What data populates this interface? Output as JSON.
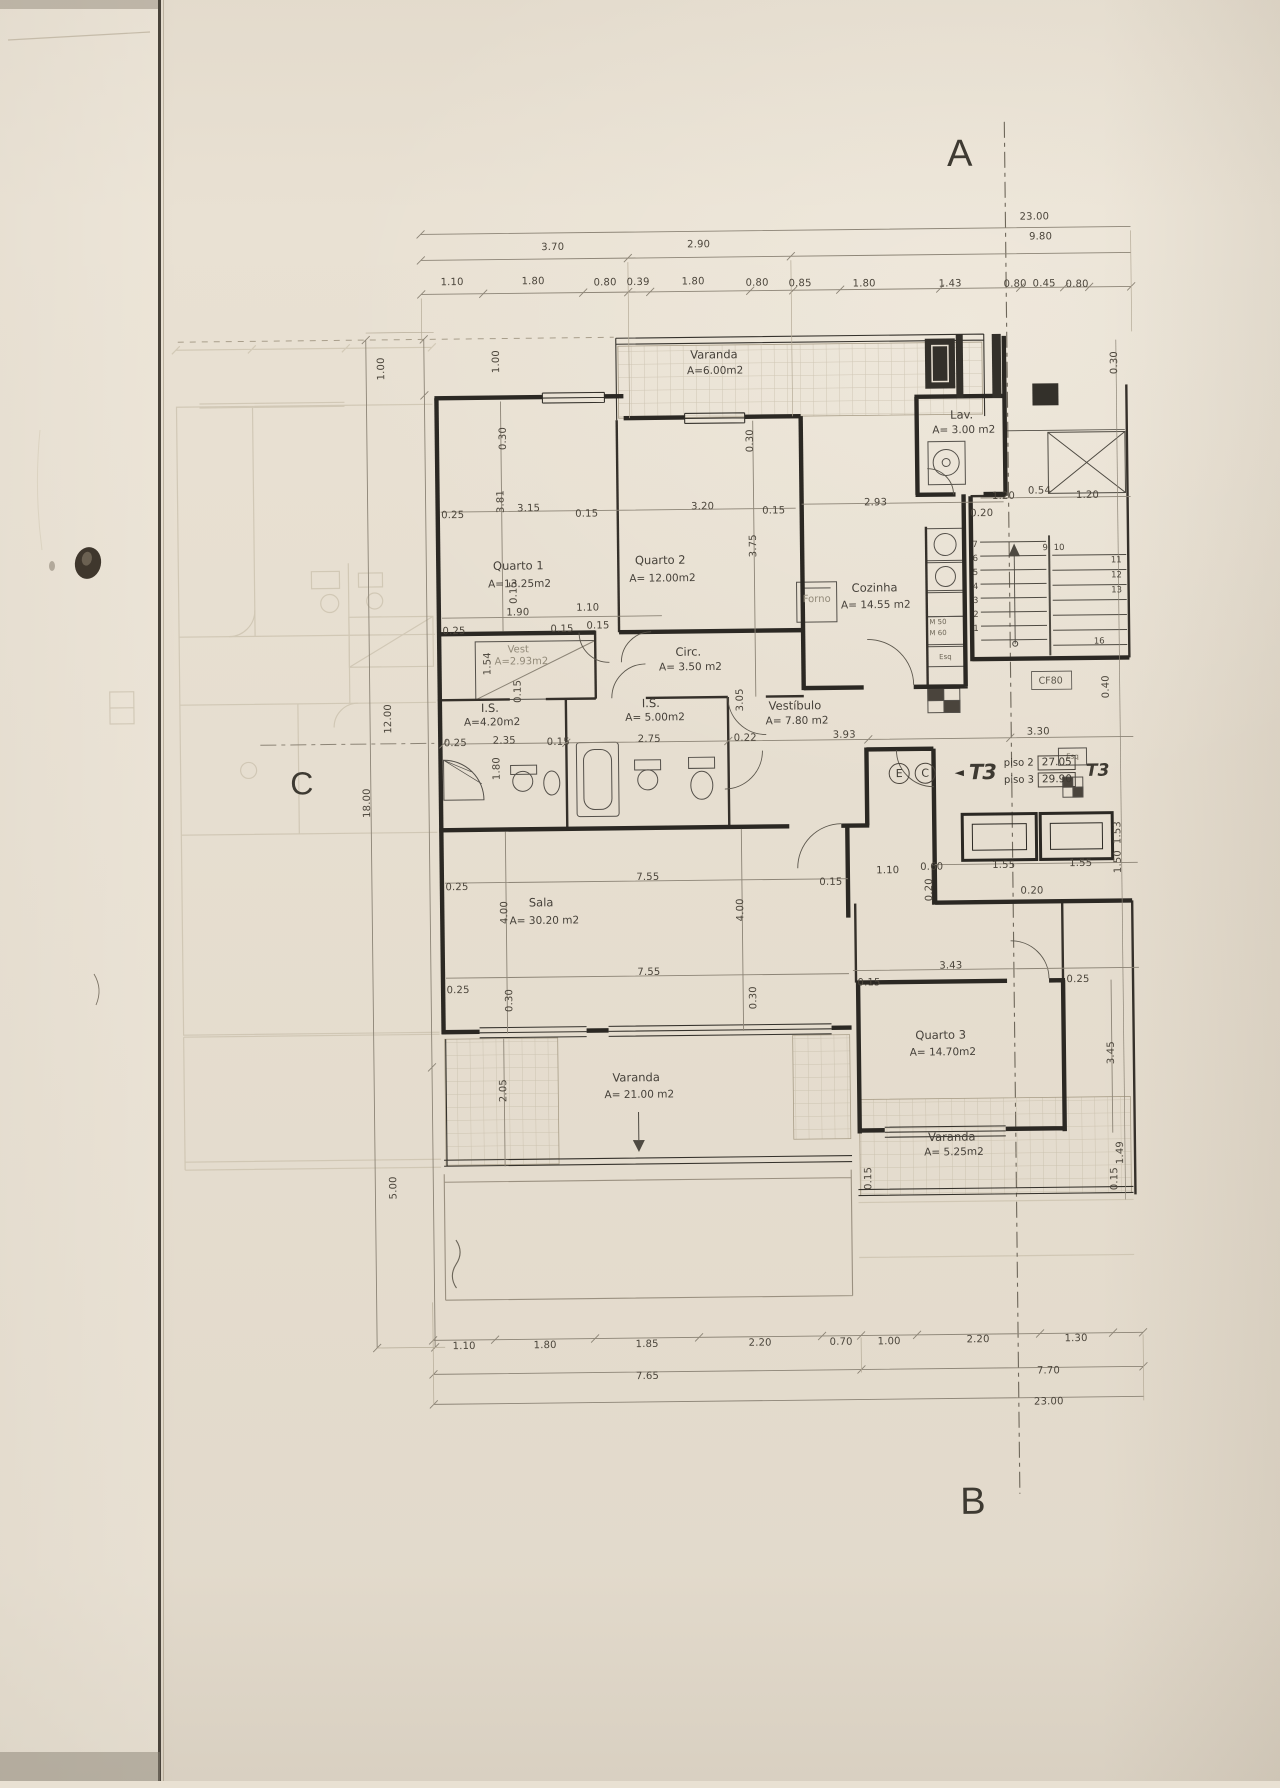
{
  "document": {
    "kind": "architectural floor plan scan",
    "language": "pt"
  },
  "markers": {
    "top": "A",
    "bottom": "B",
    "left": "C"
  },
  "unit": {
    "circle1": "E",
    "circle2": "C",
    "arrow": "◄",
    "type_left": "T3",
    "type_right": "T3",
    "rows": [
      {
        "label": "piso 2",
        "value": "27.05"
      },
      {
        "label": "piso 3",
        "value": "29.90"
      }
    ]
  },
  "colors": {
    "paper": "#e9e1d3",
    "ink": "#2e2b25",
    "dim_line": "#8c8476",
    "ghost": "#c3b9a4"
  },
  "labels": [
    {
      "t": "Varanda",
      "x": 720,
      "y": 356,
      "k": "room"
    },
    {
      "t": "A=6.00m2",
      "x": 721,
      "y": 372,
      "k": "area"
    },
    {
      "t": "Quarto 1",
      "x": 522,
      "y": 565,
      "k": "room"
    },
    {
      "t": "A=13.25m2",
      "x": 523,
      "y": 583,
      "k": "area"
    },
    {
      "t": "Quarto 2",
      "x": 664,
      "y": 561,
      "k": "room"
    },
    {
      "t": "A= 12.00m2",
      "x": 666,
      "y": 579,
      "k": "area"
    },
    {
      "t": "Lav.",
      "x": 967,
      "y": 419,
      "k": "room"
    },
    {
      "t": "A= 3.00 m2",
      "x": 969,
      "y": 434,
      "k": "area"
    },
    {
      "t": "Cozinha",
      "x": 878,
      "y": 591,
      "k": "room"
    },
    {
      "t": "A= 14.55 m2",
      "x": 879,
      "y": 608,
      "k": "area"
    },
    {
      "t": "Vest",
      "x": 521,
      "y": 649,
      "k": "gnote"
    },
    {
      "t": "A=2.93m2",
      "x": 524,
      "y": 661,
      "k": "gnote"
    },
    {
      "t": "Circ.",
      "x": 691,
      "y": 653,
      "k": "room"
    },
    {
      "t": "A= 3.50 m2",
      "x": 693,
      "y": 668,
      "k": "area"
    },
    {
      "t": "I.S.",
      "x": 492,
      "y": 707,
      "k": "room"
    },
    {
      "t": "A=4.20m2",
      "x": 494,
      "y": 721,
      "k": "area"
    },
    {
      "t": "I.S.",
      "x": 653,
      "y": 704,
      "k": "room"
    },
    {
      "t": "A= 5.00m2",
      "x": 657,
      "y": 718,
      "k": "area"
    },
    {
      "t": "Vestíbulo",
      "x": 797,
      "y": 708,
      "k": "room"
    },
    {
      "t": "A= 7.80 m2",
      "x": 799,
      "y": 723,
      "k": "area"
    },
    {
      "t": "Sala",
      "x": 541,
      "y": 902,
      "k": "room"
    },
    {
      "t": "A= 30.20 m2",
      "x": 544,
      "y": 920,
      "k": "area"
    },
    {
      "t": "Quarto 3",
      "x": 939,
      "y": 1039,
      "k": "room"
    },
    {
      "t": "A= 14.70m2",
      "x": 941,
      "y": 1056,
      "k": "area"
    },
    {
      "t": "Varanda",
      "x": 634,
      "y": 1078,
      "k": "room"
    },
    {
      "t": "A= 21.00 m2",
      "x": 637,
      "y": 1095,
      "k": "area"
    },
    {
      "t": "Varanda",
      "x": 949,
      "y": 1141,
      "k": "room"
    },
    {
      "t": "A= 5.25m2",
      "x": 951,
      "y": 1156,
      "k": "area"
    },
    {
      "t": "Forno",
      "x": 820,
      "y": 602,
      "k": "gnote"
    },
    {
      "t": "CF80",
      "x": 1053,
      "y": 686,
      "k": "note"
    },
    {
      "t": "Esq",
      "x": 948,
      "y": 661,
      "k": "tiny"
    },
    {
      "t": "Esq",
      "x": 1074,
      "y": 762,
      "k": "tiny"
    },
    {
      "t": "M 50",
      "x": 941,
      "y": 626,
      "k": "tiny"
    },
    {
      "t": "M 60",
      "x": 941,
      "y": 637,
      "k": "tiny"
    },
    {
      "t": "23.00",
      "x": 1042,
      "y": 222,
      "k": "dim"
    },
    {
      "t": "3.70",
      "x": 560,
      "y": 247,
      "k": "dim"
    },
    {
      "t": "2.90",
      "x": 706,
      "y": 246,
      "k": "dim"
    },
    {
      "t": "9.80",
      "x": 1048,
      "y": 242,
      "k": "dim"
    },
    {
      "t": "1.10",
      "x": 459,
      "y": 281,
      "k": "dim"
    },
    {
      "t": "1.80",
      "x": 540,
      "y": 281,
      "k": "dim"
    },
    {
      "t": "0.80",
      "x": 612,
      "y": 283,
      "k": "dim"
    },
    {
      "t": "0.39",
      "x": 645,
      "y": 283,
      "k": "dim"
    },
    {
      "t": "1.80",
      "x": 700,
      "y": 283,
      "k": "dim"
    },
    {
      "t": "0.80",
      "x": 764,
      "y": 285,
      "k": "dim"
    },
    {
      "t": "0.85",
      "x": 807,
      "y": 286,
      "k": "dim"
    },
    {
      "t": "1.80",
      "x": 871,
      "y": 287,
      "k": "dim"
    },
    {
      "t": "1.43",
      "x": 957,
      "y": 288,
      "k": "dim"
    },
    {
      "t": "0.80",
      "x": 1022,
      "y": 289,
      "k": "dim"
    },
    {
      "t": "0.45",
      "x": 1051,
      "y": 289,
      "k": "dim"
    },
    {
      "t": "0.80",
      "x": 1084,
      "y": 290,
      "k": "dim"
    },
    {
      "t": "1.00",
      "x": 388,
      "y": 366,
      "k": "vdim"
    },
    {
      "t": "1.00",
      "x": 503,
      "y": 360,
      "k": "vdim"
    },
    {
      "t": "18.00",
      "x": 369,
      "y": 800,
      "k": "vdim"
    },
    {
      "t": "12.00",
      "x": 391,
      "y": 716,
      "k": "vdim"
    },
    {
      "t": "5.00",
      "x": 391,
      "y": 1185,
      "k": "vdim"
    },
    {
      "t": "0.30",
      "x": 1121,
      "y": 368,
      "k": "vdim"
    },
    {
      "t": "0.30",
      "x": 509,
      "y": 437,
      "k": "vdim"
    },
    {
      "t": "3.81",
      "x": 506,
      "y": 500,
      "k": "vdim"
    },
    {
      "t": "0.30",
      "x": 756,
      "y": 442,
      "k": "vdim"
    },
    {
      "t": "3.75",
      "x": 758,
      "y": 547,
      "k": "vdim"
    },
    {
      "t": "0.15",
      "x": 518,
      "y": 591,
      "k": "vdim"
    },
    {
      "t": "1.54",
      "x": 491,
      "y": 662,
      "k": "vdim"
    },
    {
      "t": "0.15",
      "x": 521,
      "y": 690,
      "k": "vdim"
    },
    {
      "t": "1.80",
      "x": 499,
      "y": 767,
      "k": "vdim"
    },
    {
      "t": "3.05",
      "x": 743,
      "y": 701,
      "k": "vdim"
    },
    {
      "t": "0.40",
      "x": 1109,
      "y": 692,
      "k": "vdim"
    },
    {
      "t": "1.53",
      "x": 1119,
      "y": 838,
      "k": "vdim"
    },
    {
      "t": "1.50",
      "x": 1119,
      "y": 867,
      "k": "vdim"
    },
    {
      "t": "0.20",
      "x": 930,
      "y": 893,
      "k": "vdim"
    },
    {
      "t": "4.00",
      "x": 505,
      "y": 911,
      "k": "vdim"
    },
    {
      "t": "4.00",
      "x": 741,
      "y": 911,
      "k": "vdim"
    },
    {
      "t": "0.30",
      "x": 509,
      "y": 999,
      "k": "vdim"
    },
    {
      "t": "0.30",
      "x": 753,
      "y": 999,
      "k": "vdim"
    },
    {
      "t": "3.45",
      "x": 1110,
      "y": 1058,
      "k": "vdim"
    },
    {
      "t": "2.05",
      "x": 502,
      "y": 1089,
      "k": "vdim"
    },
    {
      "t": "1.49",
      "x": 1118,
      "y": 1158,
      "k": "vdim"
    },
    {
      "t": "0.15",
      "x": 1112,
      "y": 1184,
      "k": "vdim"
    },
    {
      "t": "0.15",
      "x": 866,
      "y": 1181,
      "k": "vdim"
    },
    {
      "t": "0.25",
      "x": 457,
      "y": 514,
      "k": "dim"
    },
    {
      "t": "3.15",
      "x": 533,
      "y": 508,
      "k": "dim"
    },
    {
      "t": "0.15",
      "x": 591,
      "y": 514,
      "k": "dim"
    },
    {
      "t": "3.20",
      "x": 707,
      "y": 508,
      "k": "dim"
    },
    {
      "t": "0.15",
      "x": 778,
      "y": 513,
      "k": "dim"
    },
    {
      "t": "2.93",
      "x": 880,
      "y": 506,
      "k": "dim"
    },
    {
      "t": "0.20",
      "x": 986,
      "y": 518,
      "k": "dim"
    },
    {
      "t": "1.20",
      "x": 1008,
      "y": 501,
      "k": "dim"
    },
    {
      "t": "0.54",
      "x": 1044,
      "y": 496,
      "k": "dim"
    },
    {
      "t": "1.20",
      "x": 1092,
      "y": 501,
      "k": "dim"
    },
    {
      "t": "1.90",
      "x": 521,
      "y": 612,
      "k": "dim"
    },
    {
      "t": "1.10",
      "x": 591,
      "y": 608,
      "k": "dim"
    },
    {
      "t": "0.25",
      "x": 457,
      "y": 630,
      "k": "dim"
    },
    {
      "t": "0.15",
      "x": 565,
      "y": 629,
      "k": "dim"
    },
    {
      "t": "0.15",
      "x": 601,
      "y": 626,
      "k": "dim"
    },
    {
      "t": "0.25",
      "x": 457,
      "y": 742,
      "k": "dim"
    },
    {
      "t": "2.35",
      "x": 506,
      "y": 740,
      "k": "dim"
    },
    {
      "t": "0.15",
      "x": 560,
      "y": 742,
      "k": "dim"
    },
    {
      "t": "2.75",
      "x": 651,
      "y": 740,
      "k": "dim"
    },
    {
      "t": "0.22",
      "x": 747,
      "y": 740,
      "k": "dim"
    },
    {
      "t": "3.93",
      "x": 846,
      "y": 738,
      "k": "dim"
    },
    {
      "t": "3.30",
      "x": 1040,
      "y": 737,
      "k": "dim"
    },
    {
      "t": "0.25",
      "x": 457,
      "y": 886,
      "k": "dim"
    },
    {
      "t": "7.55",
      "x": 648,
      "y": 878,
      "k": "dim"
    },
    {
      "t": "0.15",
      "x": 831,
      "y": 885,
      "k": "dim"
    },
    {
      "t": "1.10",
      "x": 888,
      "y": 874,
      "k": "dim"
    },
    {
      "t": "0.60",
      "x": 932,
      "y": 871,
      "k": "dim"
    },
    {
      "t": "1.55",
      "x": 1004,
      "y": 870,
      "k": "dim"
    },
    {
      "t": "1.55",
      "x": 1081,
      "y": 869,
      "k": "dim"
    },
    {
      "t": "0.20",
      "x": 1032,
      "y": 896,
      "k": "dim"
    },
    {
      "t": "7.55",
      "x": 648,
      "y": 973,
      "k": "dim"
    },
    {
      "t": "0.25",
      "x": 457,
      "y": 989,
      "k": "dim"
    },
    {
      "t": "3.43",
      "x": 950,
      "y": 970,
      "k": "dim"
    },
    {
      "t": "0.15",
      "x": 868,
      "y": 986,
      "k": "dim"
    },
    {
      "t": "0.25",
      "x": 1077,
      "y": 985,
      "k": "dim"
    },
    {
      "t": "1.10",
      "x": 459,
      "y": 1345,
      "k": "dim"
    },
    {
      "t": "1.80",
      "x": 540,
      "y": 1345,
      "k": "dim"
    },
    {
      "t": "1.85",
      "x": 642,
      "y": 1345,
      "k": "dim"
    },
    {
      "t": "2.20",
      "x": 755,
      "y": 1345,
      "k": "dim"
    },
    {
      "t": "0.70",
      "x": 836,
      "y": 1345,
      "k": "dim"
    },
    {
      "t": "1.00",
      "x": 884,
      "y": 1345,
      "k": "dim"
    },
    {
      "t": "2.20",
      "x": 973,
      "y": 1344,
      "k": "dim"
    },
    {
      "t": "1.30",
      "x": 1071,
      "y": 1344,
      "k": "dim"
    },
    {
      "t": "7.65",
      "x": 642,
      "y": 1377,
      "k": "dim"
    },
    {
      "t": "7.70",
      "x": 1043,
      "y": 1376,
      "k": "dim"
    },
    {
      "t": "23.00",
      "x": 1043,
      "y": 1407,
      "k": "dim"
    },
    {
      "t": "7",
      "x": 979,
      "y": 549,
      "k": "stair"
    },
    {
      "t": "6",
      "x": 979,
      "y": 563,
      "k": "stair"
    },
    {
      "t": "5",
      "x": 979,
      "y": 577,
      "k": "stair"
    },
    {
      "t": "4",
      "x": 979,
      "y": 591,
      "k": "stair"
    },
    {
      "t": "3",
      "x": 979,
      "y": 605,
      "k": "stair"
    },
    {
      "t": "2",
      "x": 979,
      "y": 619,
      "k": "stair"
    },
    {
      "t": "1",
      "x": 979,
      "y": 633,
      "k": "stair"
    },
    {
      "t": "9",
      "x": 1049,
      "y": 553,
      "k": "stair"
    },
    {
      "t": "10",
      "x": 1063,
      "y": 553,
      "k": "stair"
    },
    {
      "t": "11",
      "x": 1120,
      "y": 566,
      "k": "stair"
    },
    {
      "t": "12",
      "x": 1120,
      "y": 581,
      "k": "stair"
    },
    {
      "t": "13",
      "x": 1120,
      "y": 596,
      "k": "stair"
    },
    {
      "t": "16",
      "x": 1102,
      "y": 647,
      "k": "stair"
    }
  ]
}
